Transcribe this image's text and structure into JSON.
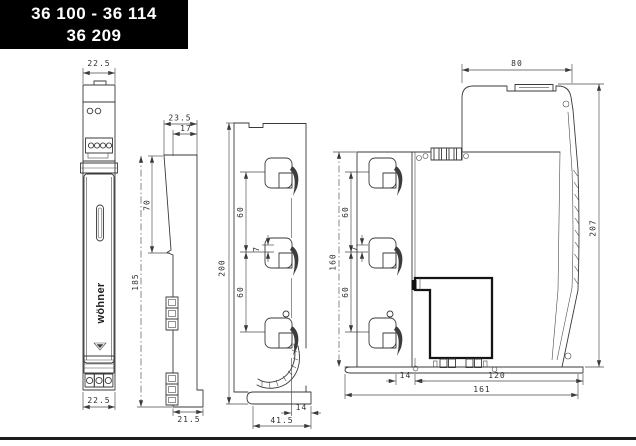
{
  "title_block": {
    "line1": "36 100 - 36 114",
    "line2": "36 209"
  },
  "brand": {
    "logo": "wöhner"
  },
  "colors": {
    "line": "#3a3a3a",
    "title_bg": "#000000",
    "title_fg": "#ffffff"
  },
  "views": {
    "front": {
      "dim_width_top": "22.5",
      "dim_width_bottom": "22.5"
    },
    "side": {
      "dim_depth": "23.5",
      "dim_front_depth": "17",
      "dim_slope_height": "70",
      "dim_height": "185",
      "dim_foot": "21.5"
    },
    "busbar_profile": {
      "dim_height": "200",
      "dim_pitch_top": "60",
      "dim_offset": "7",
      "dim_pitch_bottom": "60",
      "dim_foot": "41.5",
      "dim_foot_overhang": "14"
    },
    "assembly": {
      "dim_top_width": "80",
      "dim_total_height": "207",
      "dim_mount_height": "160",
      "dim_pitch_top": "60",
      "dim_offset": "7",
      "dim_pitch_bottom": "60",
      "dim_base_offset": "14",
      "dim_base_depth": "120",
      "dim_base_total": "161"
    }
  }
}
